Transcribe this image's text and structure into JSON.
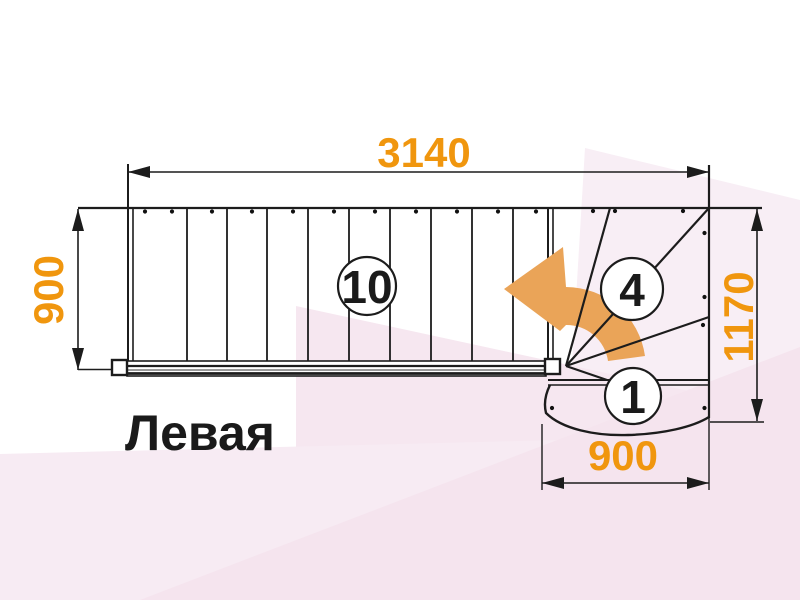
{
  "title_label": "Левая",
  "dimensions": {
    "top": "3140",
    "left": "900",
    "right": "1170",
    "bottom": "900"
  },
  "step_labels": {
    "flight_steps": "10",
    "winder_steps": "4",
    "bottom_step": "1"
  },
  "colors": {
    "dimension_text": "#f0960e",
    "turn_arrow": "#eaa458",
    "line": "#1c1c1c",
    "background_tint_right": "#f8eef5",
    "background_tint_mid": "#f6e7f0",
    "background_tint_bottom": "#f7ebf3",
    "background_tint_diag": "#f5e4ee"
  }
}
